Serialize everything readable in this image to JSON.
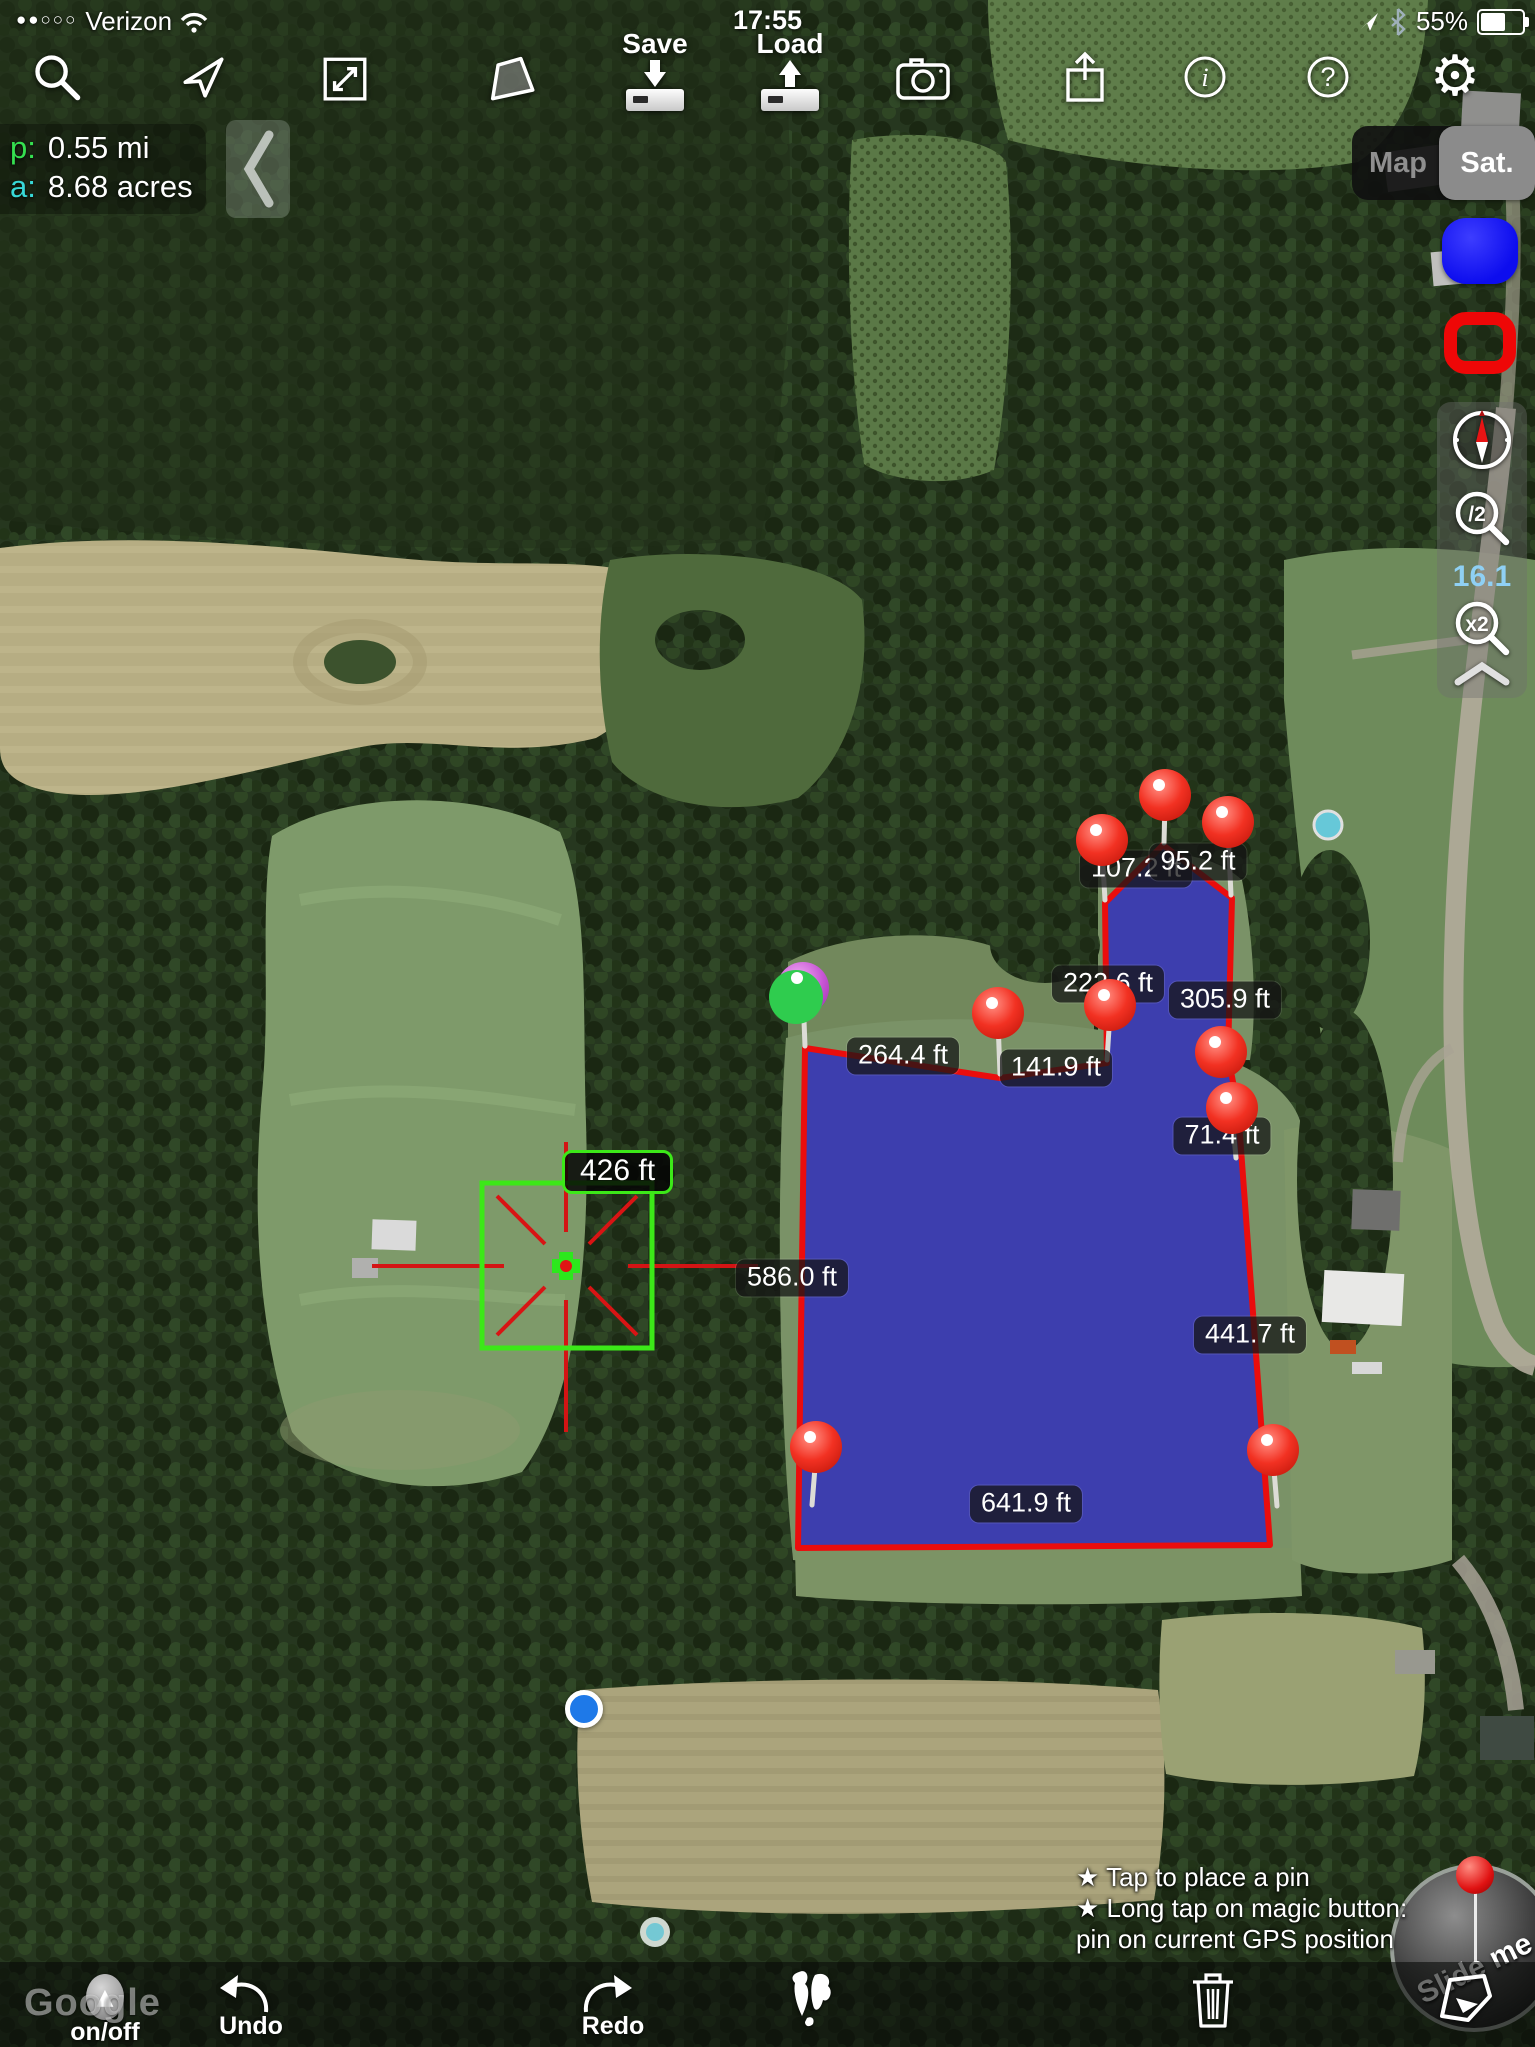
{
  "status_bar": {
    "signal_dots": "●●○○○",
    "carrier": "Verizon",
    "time": "17:55",
    "battery_percent": "55%"
  },
  "top_toolbar": {
    "save_label": "Save",
    "load_label": "Load"
  },
  "measure_readout": {
    "perimeter_key": "p:",
    "perimeter_value": "0.55 mi",
    "area_key": "a:",
    "area_value": "8.68 acres"
  },
  "map_type_toggle": {
    "map_label": "Map",
    "sat_label": "Sat."
  },
  "zoom_panel": {
    "zoom_out_label": "/2",
    "zoom_value": "16.1",
    "zoom_in_label": "x2"
  },
  "square_tool": {
    "side_label": "426 ft"
  },
  "map_overlay": {
    "polygon_points": "805,1048 1000,1078 1107,1063 1105,903 1163,845 1232,898 1228,1056 1238,1108 1270,1545 798,1548",
    "edge_labels": [
      {
        "text": "107.2 ft",
        "x": 1136,
        "y": 869
      },
      {
        "text": "95.2 ft",
        "x": 1198,
        "y": 862
      },
      {
        "text": "222.6 ft",
        "x": 1108,
        "y": 984
      },
      {
        "text": "305.9 ft",
        "x": 1225,
        "y": 1000
      },
      {
        "text": "264.4 ft",
        "x": 903,
        "y": 1056
      },
      {
        "text": "141.9 ft",
        "x": 1056,
        "y": 1068
      },
      {
        "text": "71.4 ft",
        "x": 1222,
        "y": 1136
      },
      {
        "text": "586.0 ft",
        "x": 792,
        "y": 1278
      },
      {
        "text": "441.7 ft",
        "x": 1250,
        "y": 1335
      },
      {
        "text": "641.9 ft",
        "x": 1026,
        "y": 1504
      }
    ],
    "pins": [
      {
        "x": 1102,
        "y": 840,
        "tx": 1105,
        "ty": 900,
        "color": "red"
      },
      {
        "x": 1165,
        "y": 795,
        "tx": 1164,
        "ty": 843,
        "color": "red"
      },
      {
        "x": 1228,
        "y": 822,
        "tx": 1231,
        "ty": 895,
        "color": "red"
      },
      {
        "x": 998,
        "y": 1013,
        "tx": 1000,
        "ty": 1074,
        "color": "red"
      },
      {
        "x": 1110,
        "y": 1005,
        "tx": 1107,
        "ty": 1060,
        "color": "red"
      },
      {
        "x": 1221,
        "y": 1052,
        "tx": 1227,
        "ty": 1058,
        "color": "red"
      },
      {
        "x": 1232,
        "y": 1108,
        "tx": 1236,
        "ty": 1158,
        "color": "red"
      },
      {
        "x": 816,
        "y": 1447,
        "tx": 812,
        "ty": 1505,
        "color": "red"
      },
      {
        "x": 1273,
        "y": 1450,
        "tx": 1277,
        "ty": 1506,
        "color": "red"
      },
      {
        "x": 803,
        "y": 988,
        "tx": 805,
        "ty": 1046,
        "color": "purple"
      }
    ]
  },
  "hint_box": {
    "line1": "★ Tap to place a pin",
    "line2": "★ Long tap on magic button:",
    "line3": "pin on current GPS position"
  },
  "slide_button": {
    "label": "Slide me"
  },
  "bottom_toolbar": {
    "onoff_label": "on/off",
    "onoff_glyph": "▲",
    "undo_label": "Undo",
    "redo_label": "Redo"
  },
  "watermark": "Google",
  "colors": {
    "polygon_fill": "rgba(48,44,190,0.82)",
    "polygon_stroke": "#ea0d0d",
    "square_green": "#3ce818",
    "crosshair_red": "#d41414",
    "blue_button": "#0d0dee",
    "red_button": "#ee0707",
    "zoom_value_blue": "#8fd0f4"
  }
}
